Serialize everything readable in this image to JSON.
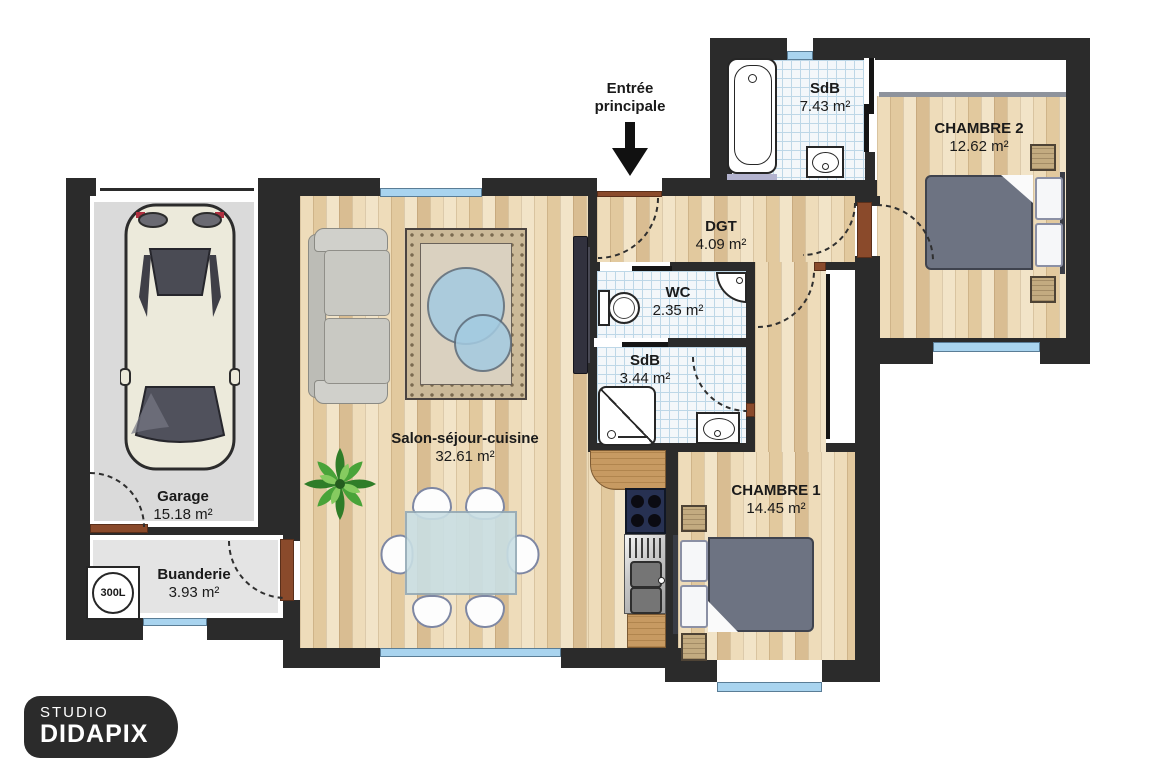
{
  "entrance": {
    "line1": "Entrée",
    "line2": "principale"
  },
  "icons": {
    "entrance_arrow": "arrow-down"
  },
  "rooms": {
    "garage": {
      "name": "Garage",
      "area": "15.18 m²"
    },
    "buanderie": {
      "name": "Buanderie",
      "area": "3.93 m²"
    },
    "salon": {
      "name": "Salon-séjour-cuisine",
      "area": "32.61 m²"
    },
    "wc": {
      "name": "WC",
      "area": "2.35 m²"
    },
    "sdb_small": {
      "name": "SdB",
      "area": "3.44 m²"
    },
    "dgt": {
      "name": "DGT",
      "area": "4.09 m²"
    },
    "sdb_top": {
      "name": "SdB",
      "area": "7.43 m²"
    },
    "chambre1": {
      "name": "CHAMBRE 1",
      "area": "14.45 m²"
    },
    "chambre2": {
      "name": "CHAMBRE 2",
      "area": "12.62 m²"
    }
  },
  "equipment": {
    "water_heater_label": "300L"
  },
  "logo": {
    "studio": "STUDIO",
    "name": "DIDAPIX"
  },
  "colors": {
    "wall": "#2b2b2b",
    "wood_a": "#eedcba",
    "wood_b": "#e2c99e",
    "wood_c": "#f2e4c8",
    "wood_d": "#d9bd92",
    "tile_bg": "#f3f7fa",
    "tile_line": "#bdd7e7",
    "garage_floor": "#dadada",
    "laundry_floor": "#e4e4e4",
    "window_blue": "#a9d4ef",
    "door_brown": "#8a4a2b",
    "duvet": "#6d7382",
    "sofa": "#c9c9c3",
    "table_glass": "#c9dfe4",
    "counter_wood": "#c79a62",
    "cooktop": "#273152",
    "rug_border": "#cbb998",
    "rug_field": "#dad1c0",
    "rug_circle": "#a3cbe1",
    "plant_green": "#4f9e3c",
    "closet_rail": "#8e939c",
    "text": "#1a1a1a"
  }
}
